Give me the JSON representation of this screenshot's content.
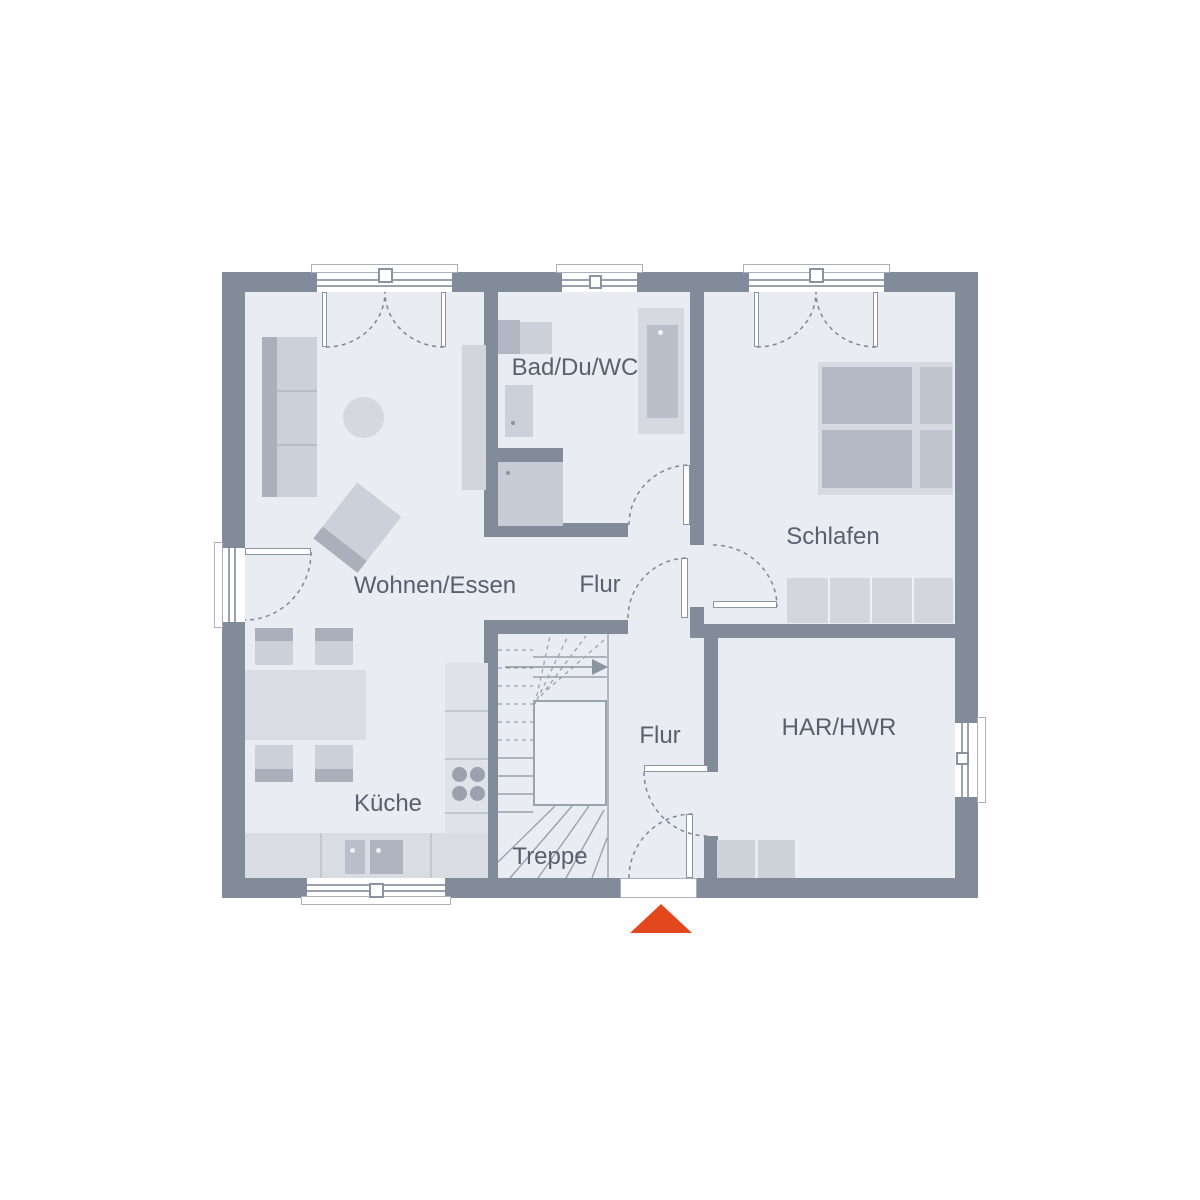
{
  "plan": {
    "type": "floor-plan",
    "rooms": [
      {
        "id": "wohnen-essen",
        "label": "Wohnen/Essen"
      },
      {
        "id": "kueche",
        "label": "Küche"
      },
      {
        "id": "bad-du-wc",
        "label": "Bad/Du/WC"
      },
      {
        "id": "flur-mitte",
        "label": "Flur"
      },
      {
        "id": "schlafen",
        "label": "Schlafen"
      },
      {
        "id": "treppe",
        "label": "Treppe"
      },
      {
        "id": "flur-unten",
        "label": "Flur"
      },
      {
        "id": "har-hwr",
        "label": "HAR/HWR"
      }
    ],
    "entrance_marker": {
      "shape": "triangle-up",
      "color": "#e2481c"
    },
    "stair_direction_arrow": "right",
    "colors": {
      "wall": "#828b99",
      "floor": "#e9ecf1",
      "furniture_light": "#d6dae0",
      "furniture_mid": "#c9ced6",
      "furniture_dark": "#a9b0bb",
      "window_line": "#9aa2ae",
      "door_arc": "#7f8898",
      "label_text": "#59606f",
      "accent": "#e2481c"
    }
  }
}
